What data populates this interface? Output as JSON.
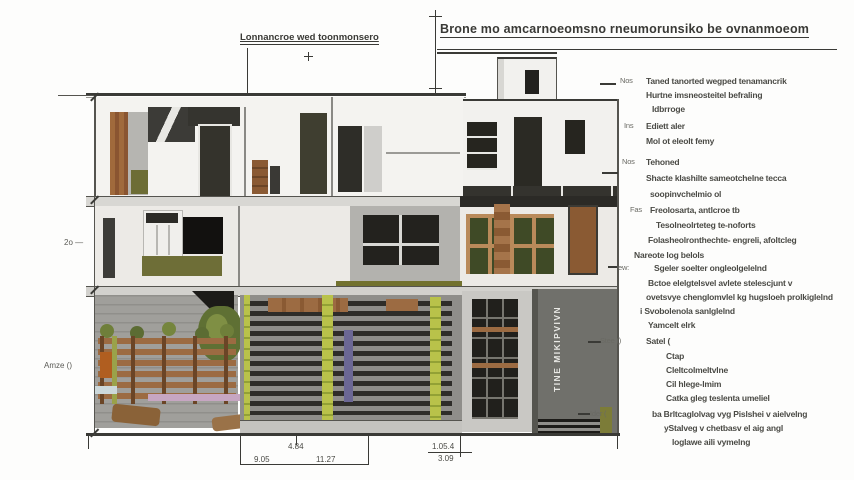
{
  "title": {
    "main": "Brone mo amcarnoeomsno rneumorunsiko be ovnanmoeom",
    "sublabel": "Lonnancroe wed toonmonsero"
  },
  "left_labels": {
    "upper": "2o —",
    "lower": "Amze ()"
  },
  "vertical_text": "TINE MIKIPVIVN",
  "notes": [
    {
      "marker": "Nos",
      "lines": [
        "Taned tanorted wegped tenamancrik",
        "Hurtne imsneosteitel befraling",
        "Idbrroge"
      ]
    },
    {
      "marker": "Ins",
      "lines": [
        "Ediett aler",
        "Mol ot eleolt femy"
      ]
    },
    {
      "marker": "Nos",
      "lines": [
        "Tehoned",
        "Shacte klashilte sameotchelne tecca",
        "soopinvchelmio ol"
      ]
    },
    {
      "marker": "Fas",
      "lines": [
        "Freolosarta, antlcroe tb",
        "Tesolneolrteteg te-noforts",
        "Folasheolronthechte- engreli, afoltcleg"
      ]
    },
    {
      "marker": "",
      "lines": [
        "Nareote log belols"
      ]
    },
    {
      "marker": "ew:",
      "lines": [
        "Sgeler soelter ongleolgelelnd",
        "Bctoe elelgtelsvel avlete stelescjunt v",
        "ovetsvye chenglomvlel kg hugsloeh prolkiglelnd",
        "i Svobolenola sanlglelnd",
        "Yamcelt elrk"
      ]
    },
    {
      "marker": "Stee ()",
      "lines": [
        "Satel (",
        "Ctap",
        "Cleltcolmeltvlne",
        "Cil hlege-lmim",
        "Catka gleg teslenta umeliel"
      ]
    },
    {
      "marker": "Ider (",
      "lines": [
        "ba Brltcaglolvag vyg Pislshei v aielvelng",
        "yStalveg v chetbasv el aig angl",
        "loglawe aili vymelng"
      ]
    }
  ],
  "dimensions": {
    "width_total": "4.84",
    "width_left": "9.05",
    "width_right": "11.27",
    "height_a": "1.05.4",
    "height_b": "3.09"
  },
  "colors": {
    "ink": "#3a3a36",
    "wall_white": "#f4f3f0",
    "wall_gray": "#a09f9b",
    "wall_dark": "#70706b",
    "wood": "#9c6b42",
    "olive": "#6e6e37",
    "bamboo": "#b9c24a",
    "slat_dark": "#2e2d29"
  }
}
